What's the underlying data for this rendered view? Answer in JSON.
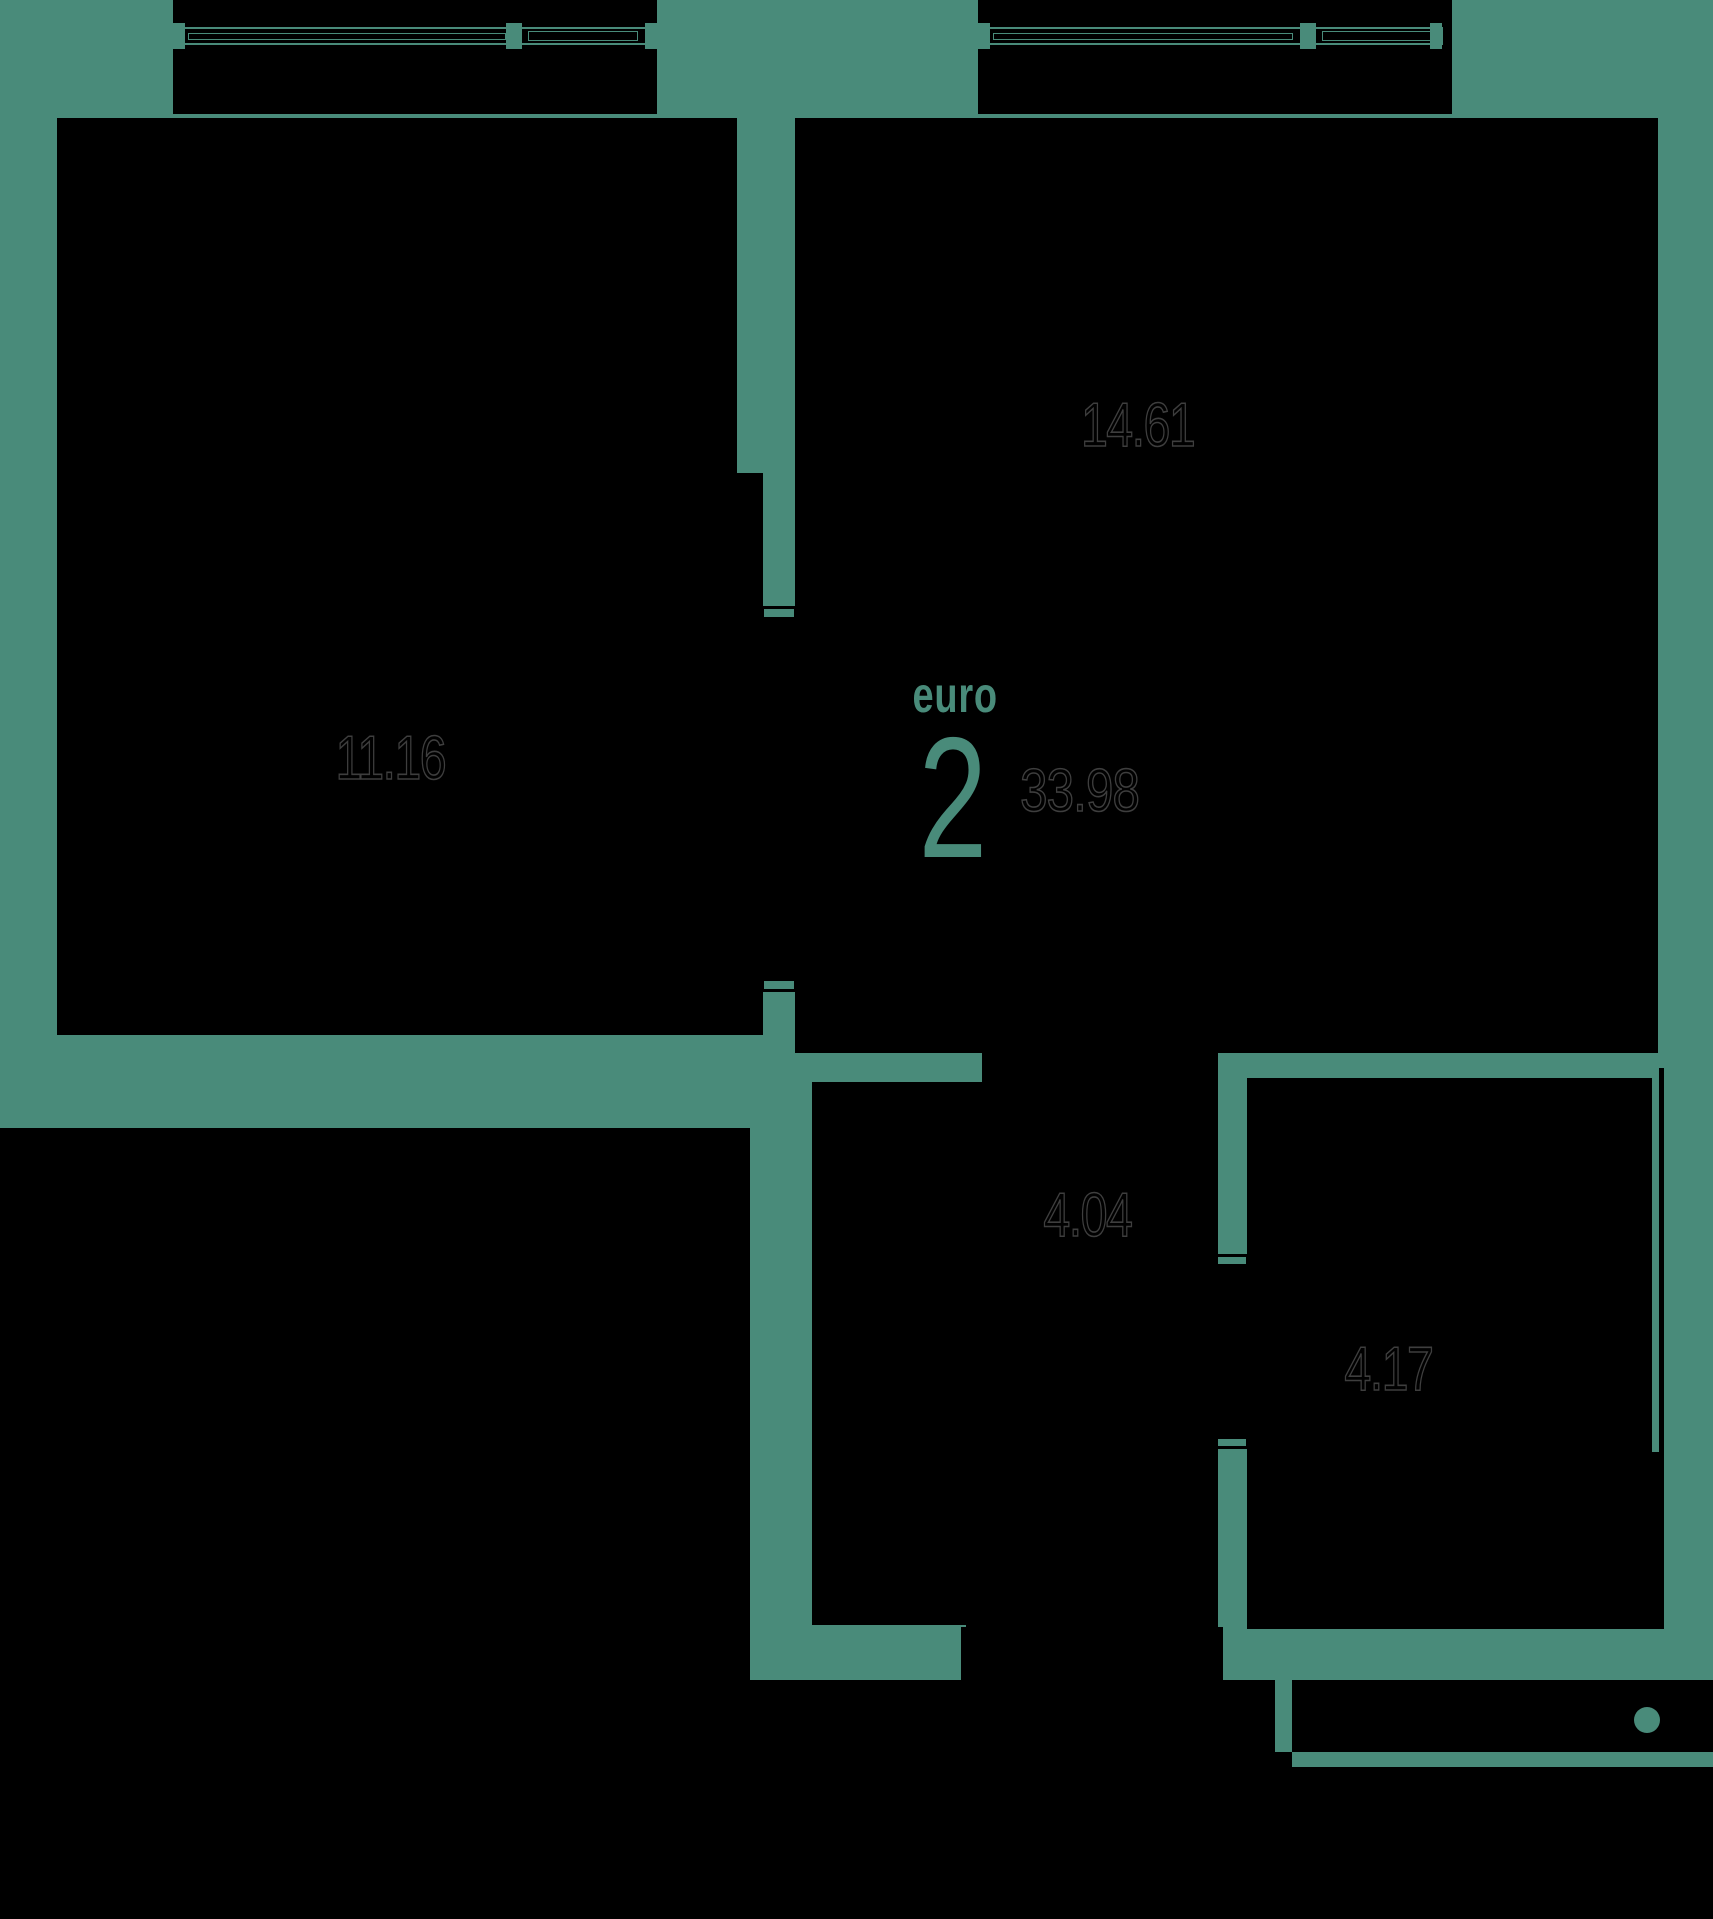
{
  "plan": {
    "title": "euro 2-room apartment floor plan",
    "badge": {
      "type_label": "euro",
      "rooms_count": "2",
      "total_area": "33.98"
    },
    "areas": {
      "room_left": "11.16",
      "room_right": "14.61",
      "hall": "4.04",
      "bathroom": "4.17"
    },
    "colors": {
      "background_teal": "#498b7a",
      "room_fill": "#000000",
      "area_text_outline": "#3e3e3e"
    }
  }
}
